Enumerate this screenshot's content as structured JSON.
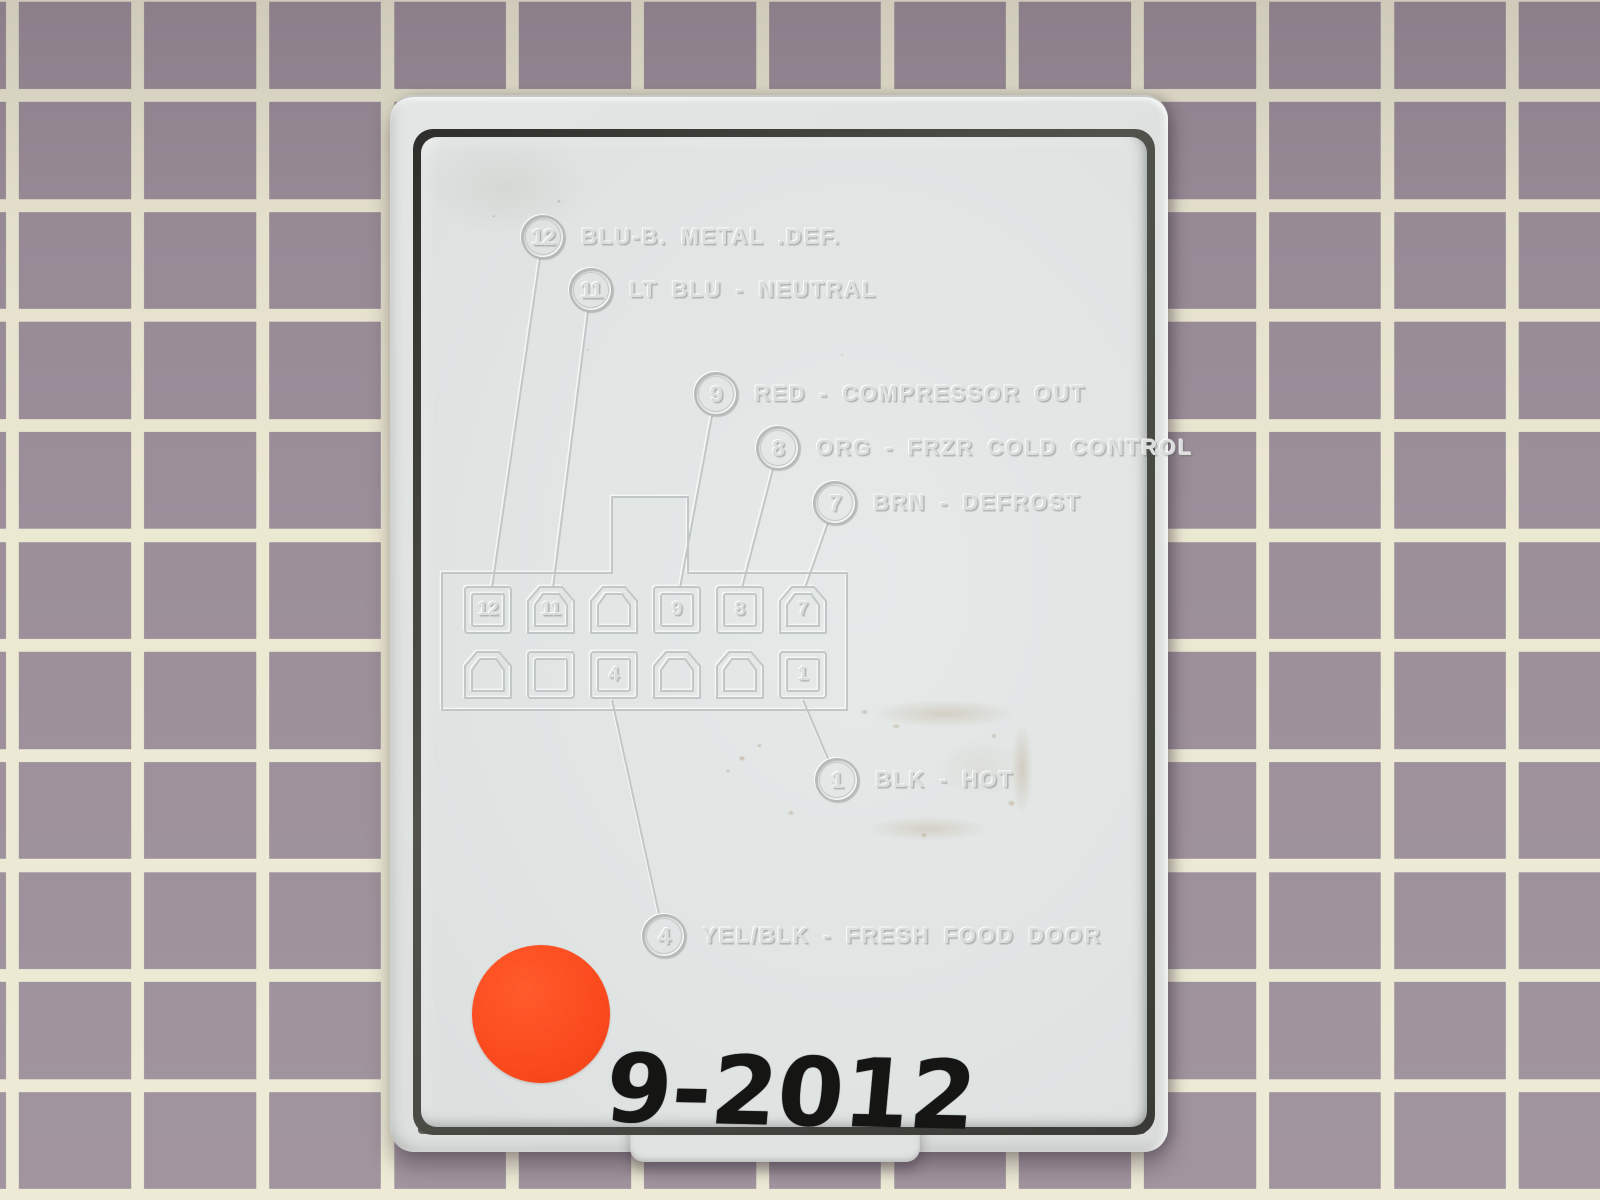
{
  "scene": {
    "handwriting": "9-2012"
  },
  "wiring_diagram": {
    "callouts": [
      {
        "num": "12",
        "label": "BLU-B. METAL .DEF."
      },
      {
        "num": "11",
        "label": "LT BLU - NEUTRAL"
      },
      {
        "num": "9",
        "label": "RED - COMPRESSOR OUT"
      },
      {
        "num": "8",
        "label": "ORG - FRZR COLD CONTROL"
      },
      {
        "num": "7",
        "label": "BRN - DEFROST"
      },
      {
        "num": "1",
        "label": "BLK - HOT"
      },
      {
        "num": "4",
        "label": "YEL/BLK - FRESH FOOD DOOR"
      }
    ],
    "connector": {
      "top_pins": [
        "12",
        "11",
        "",
        "9",
        "8",
        "7"
      ],
      "bottom_pins": [
        "",
        "",
        "4",
        "",
        "",
        "1"
      ]
    }
  },
  "colors": {
    "mat_tile": "#9c8f9a",
    "mat_grid_line": "#ece9d3",
    "cover_plastic": "#e1e5e4",
    "gap_shadow": "#3a3a36",
    "sticker_orange": "#fb4a1e",
    "marker_ink": "#151514"
  }
}
